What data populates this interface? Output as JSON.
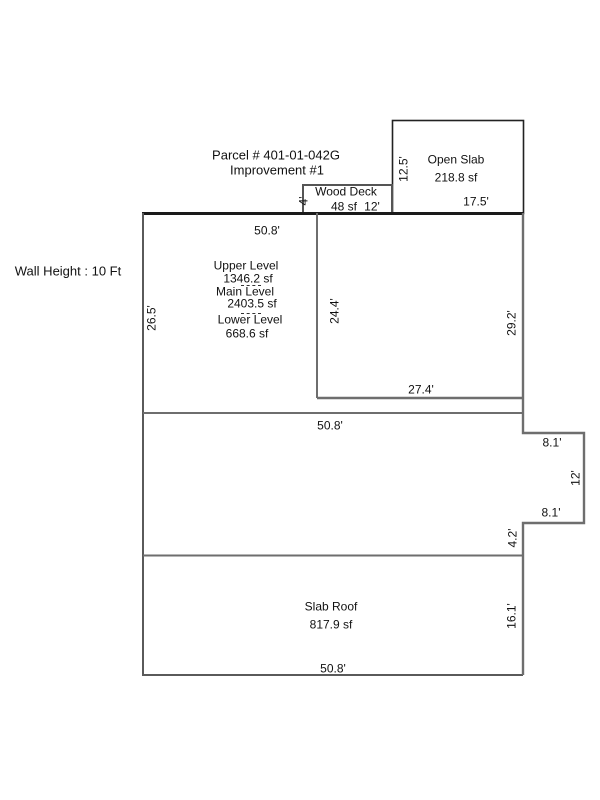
{
  "header": {
    "parcel": "Parcel # 401-01-042G",
    "improvement": "Improvement #1"
  },
  "wall_height": {
    "label": "Wall Height : 10 Ft"
  },
  "sketch": {
    "open_slab": {
      "name": "Open Slab",
      "area": "218.8 sf",
      "width": "17.5'",
      "height": "12.5'"
    },
    "wood_deck": {
      "name": "Wood Deck",
      "area": "48 sf",
      "width": "12'",
      "height": "4'"
    },
    "levels": {
      "top_width": "50.8'",
      "left_height": "26.5'",
      "upper_label": "Upper Level",
      "upper_area": "1346.2 sf",
      "main_label": "Main Level",
      "main_area": "2403.5 sf",
      "lower_label": "Lower Level",
      "lower_area": "668.6 sf",
      "inner_left": "24.4'",
      "inner_right": "29.2'",
      "inner_bottom": "27.4'"
    },
    "middle": {
      "width": "50.8'",
      "notch_top": "8.1'",
      "notch_right": "12'",
      "notch_bottom": "8.1'",
      "right_lower": "4.2'"
    },
    "slab_roof": {
      "name": "Slab Roof",
      "area": "817.9 sf",
      "right_height": "16.1'",
      "bottom_width": "50.8'"
    }
  },
  "colors": {
    "background": "#ffffff",
    "sketch_line": "#6e6e6e",
    "sketch_line_dark": "#1a1a1a",
    "text": "#111111"
  }
}
